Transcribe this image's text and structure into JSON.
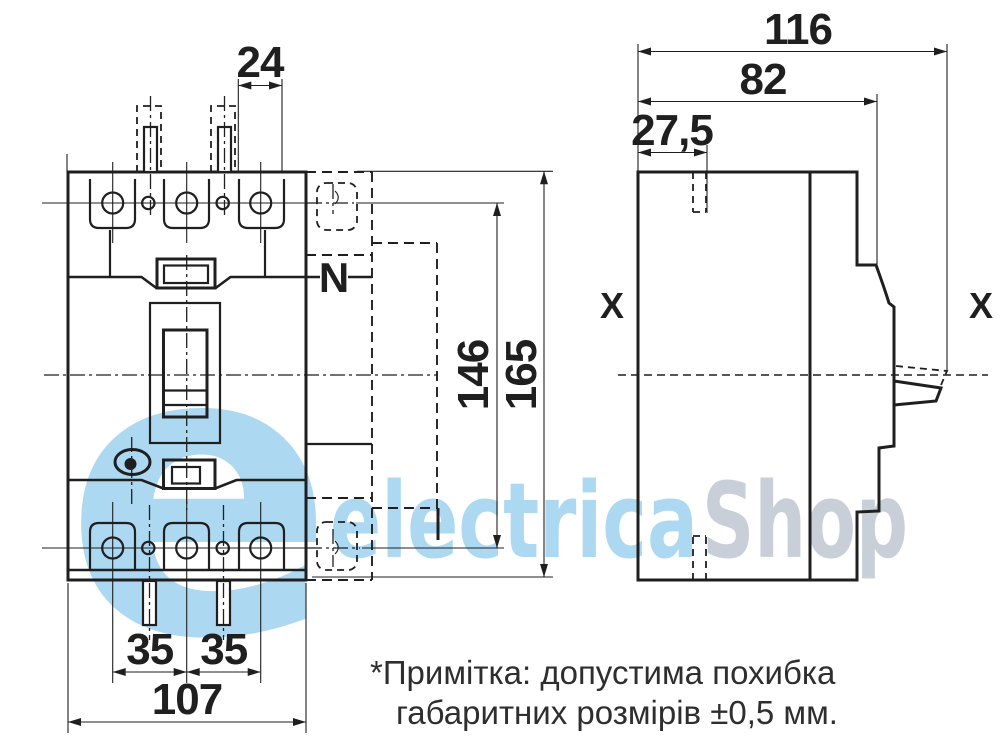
{
  "watermark": {
    "big_letter": "e",
    "brand_part1": "electrica",
    "brand_part2": "Shop",
    "color_blue": "#acd8f2",
    "color_gray": "#c8cfd8"
  },
  "front_view": {
    "dim_terminal_slot_width": "24",
    "dim_pole_pitch_left": "35",
    "dim_pole_pitch_right": "35",
    "dim_overall_width": "107",
    "dim_mounting_height": "146",
    "dim_overall_height": "165",
    "neutral_pole_label": "N"
  },
  "side_view": {
    "dim_overall_depth": "116",
    "dim_case_depth": "82",
    "dim_slot_offset": "27,5",
    "section_label_left": "X",
    "section_label_right": "X"
  },
  "note": {
    "line1": "*Примітка: допустима похибка",
    "line2": "габаритних розмірів ±0,5 мм."
  },
  "colors": {
    "line": "#1f1f1f",
    "background": "#ffffff",
    "note_text": "#2e2e2e"
  }
}
